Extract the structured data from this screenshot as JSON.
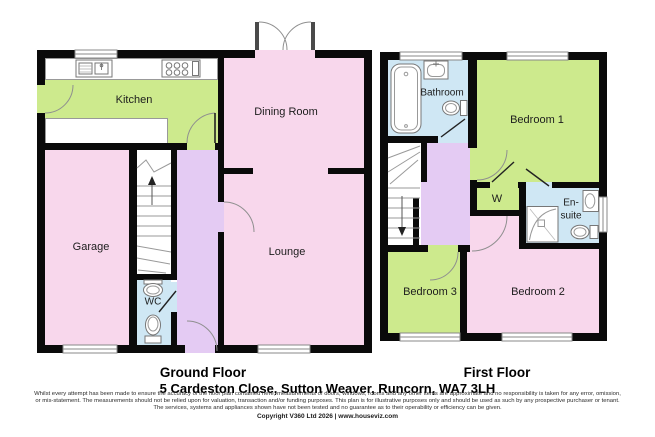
{
  "floorplan": {
    "ground_floor": {
      "title": "Ground Floor",
      "rooms": {
        "kitchen": "Kitchen",
        "dining_room": "Dining Room",
        "garage": "Garage",
        "lounge": "Lounge",
        "wc": "WC"
      }
    },
    "first_floor": {
      "title": "First Floor",
      "rooms": {
        "bathroom": "Bathroom",
        "bedroom_1": "Bedroom 1",
        "wardrobe": "W",
        "en_suite": "En-suite",
        "bedroom_3": "Bedroom 3",
        "bedroom_2": "Bedroom 2"
      }
    },
    "address": "5 Cardeston Close, Sutton Weaver, Runcorn, WA7 3LH",
    "disclaimer": {
      "line1": "Whilst every attempt has been made to ensure the accuracy of the floor plan contained here, measurements of doors, windows, rooms and any other items are approximate and no responsibility is taken for any error, omission,",
      "line2": "or mis-statement. The measurements should not be relied upon for valuation, transaction and/or funding purposes. This plan is for illustrative purposes only and should be used as such by any prospective purchaser or tenant.",
      "line3": "The services, systems and appliances shown have not been tested and no guarantee as to their operability or efficiency can be given."
    },
    "copyright": "Copyright V360 Ltd 2026 | www.houseviz.com",
    "colors": {
      "room_pink": "#f8d7ec",
      "room_green": "#cdea8d",
      "room_purple": "#e4cbf3",
      "room_blue": "#cfe7f4",
      "wall": "#0a0a0a"
    }
  }
}
